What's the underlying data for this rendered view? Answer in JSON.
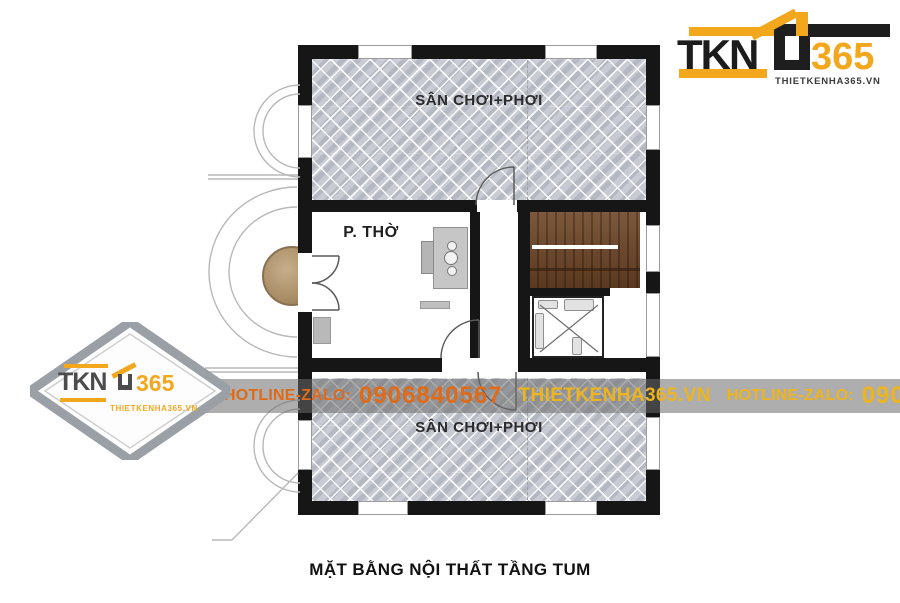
{
  "caption": "MẶT BẰNG NỘI THẤT TẦNG TUM",
  "brand": {
    "name": "TKN",
    "number": "365",
    "website": "THIETKENHA365.VN"
  },
  "watermark_band": {
    "hotline_label_1": "HOTLINE-ZALO:",
    "hotline_number_1": "0906840567",
    "website": "THIETKENHA365.VN",
    "hotline_label_2": "HOTLINE-ZALO:",
    "hotline_number_2": "0906840567"
  },
  "floor_plan": {
    "room_terrace_top": "SÂN CHƠI+PHƠI",
    "room_worship": "P. THỜ",
    "room_terrace_bottom": "SÂN CHƠI+PHƠI"
  },
  "colors": {
    "brand_orange": "#F2A71D",
    "band_text_left": "#DF6A18",
    "band_text_gold": "#EEB41E",
    "wall_black": "#161616",
    "tile_gray": "#C8CBD3",
    "stair_wood": "#6E4526"
  }
}
